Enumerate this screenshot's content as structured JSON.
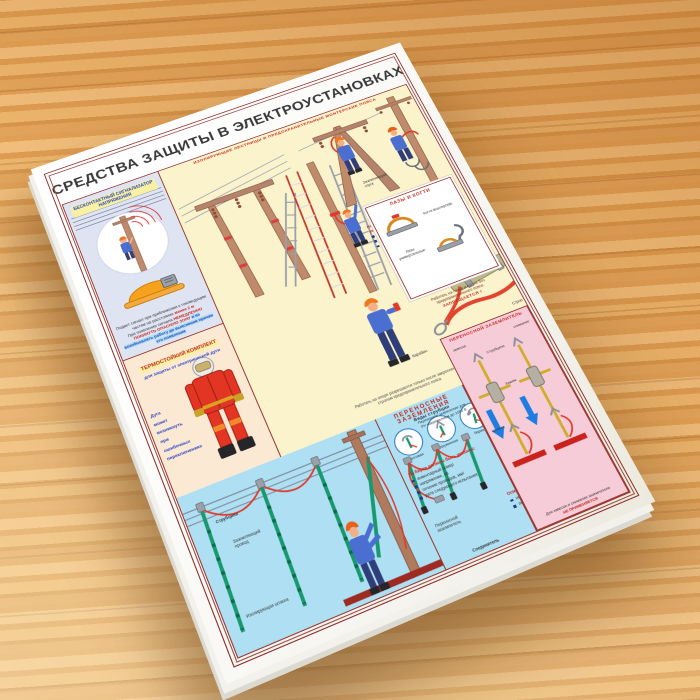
{
  "poster": {
    "title": "СРЕДСТВА ЗАЩИТЫ В ЭЛЕКТРОУСТАНОВКАХ",
    "subtitle": "ИЗОЛИРУЮЩИЕ ЛЕСТНИЦЫ И ПРЕДОХРАНИТЕЛЬНЫЕ МОНТЕРСКИЕ ПОЯСА",
    "accent_red": "#c22a20",
    "accent_blue": "#2b46c0",
    "signal_panel": {
      "heading": "БЕСКОНТАКТНЫЙ СИГНАЛИЗАТОР НАПРЯЖЕНИЯ",
      "note_top": "Подает сигнал при приближении к токоведущим частям на расстояние",
      "note_dist": "менее 2 м",
      "warning_lead": "При появлении сигнала",
      "warning_accent": "НЕМЕДЛЕННО ПОКИНУТЬ ОПАСНУЮ ЗОНУ",
      "warning_tail": "и не возобновлять работу до выяснения причин его появления"
    },
    "thermo_panel": {
      "heading": "ТЕРМОСТОЙКИЙ КОМПЛЕКТ",
      "subheading": "для защиты от электрической дуги",
      "side_note": [
        "Дуга",
        "может",
        "возникнуть",
        "при ошибочных",
        "переключениях"
      ]
    },
    "yellow_panel": {
      "label_ground_lead": "Заземляющий спуск",
      "label_carabiner": "Карабин",
      "label_strop": "Строп",
      "belt_tag_title": "На бирке пояса должны быть указаны:",
      "belt_tag_items": [
        "инвентарный номер",
        "дата испытания",
        "дата следующего испытания"
      ],
      "belt_note": "Пояса и стропы испытываются статической нагрузкой 1 раз в 6 месяцев",
      "scene_caption": "Работать на опоре разрешается только после закрепления стропом предохранительного пояса"
    },
    "claws_box": {
      "heading": "ЛАЗЫ И КОГТИ",
      "item_top": "Когти монтерские",
      "item_bottom": "Лазы универсальные",
      "warning": "Работать на лазах и когтях без предохранительного пояса",
      "warning_accent": "ЗАПРЕЩАЕТСЯ !"
    },
    "grounding_scene": {
      "label_clamp": "Струбцина",
      "label_wire": "Заземляющий провод",
      "label_rod": "Изолирующая штанга"
    },
    "portable_groundings": {
      "heading": "ПЕРЕНОСНЫЕ ЗАЗЕМЛЕНИЯ",
      "clamps_title": "Виды струбцин",
      "clamp_types": [
        "винтовая",
        "пружинная",
        "барашек"
      ],
      "rods_label": "Переносное заземление для РУ напряжением до 1000 В",
      "tag_title": "На бирке должны быть указаны:",
      "tag_items": [
        "инвентарный номер",
        "напряжение, кВ",
        "сечение проводов, мм²",
        "дата следующего испытания"
      ],
      "inspect_title": "Осматривать:",
      "inspect_items": [
        "не реже 1 раза в 3 месяца",
        "перед применением"
      ],
      "label_connector": "Соединитель",
      "label_portable": "Переносной заземлитель"
    },
    "pink_panel": {
      "heading": "ПЕРЕНОСНОЙ ЗАЗЕМЛИТЕЛЬ",
      "label_hang": "завеска",
      "label_remove": "снимание",
      "label_clamp": "Струбцина",
      "label_grip": "Зажим",
      "label_rod": "Штанга",
      "note_lead": "Для завески и снимания заземлителя",
      "note_accent": "НЕ ПРИМЕНЯЕТСЯ"
    }
  }
}
